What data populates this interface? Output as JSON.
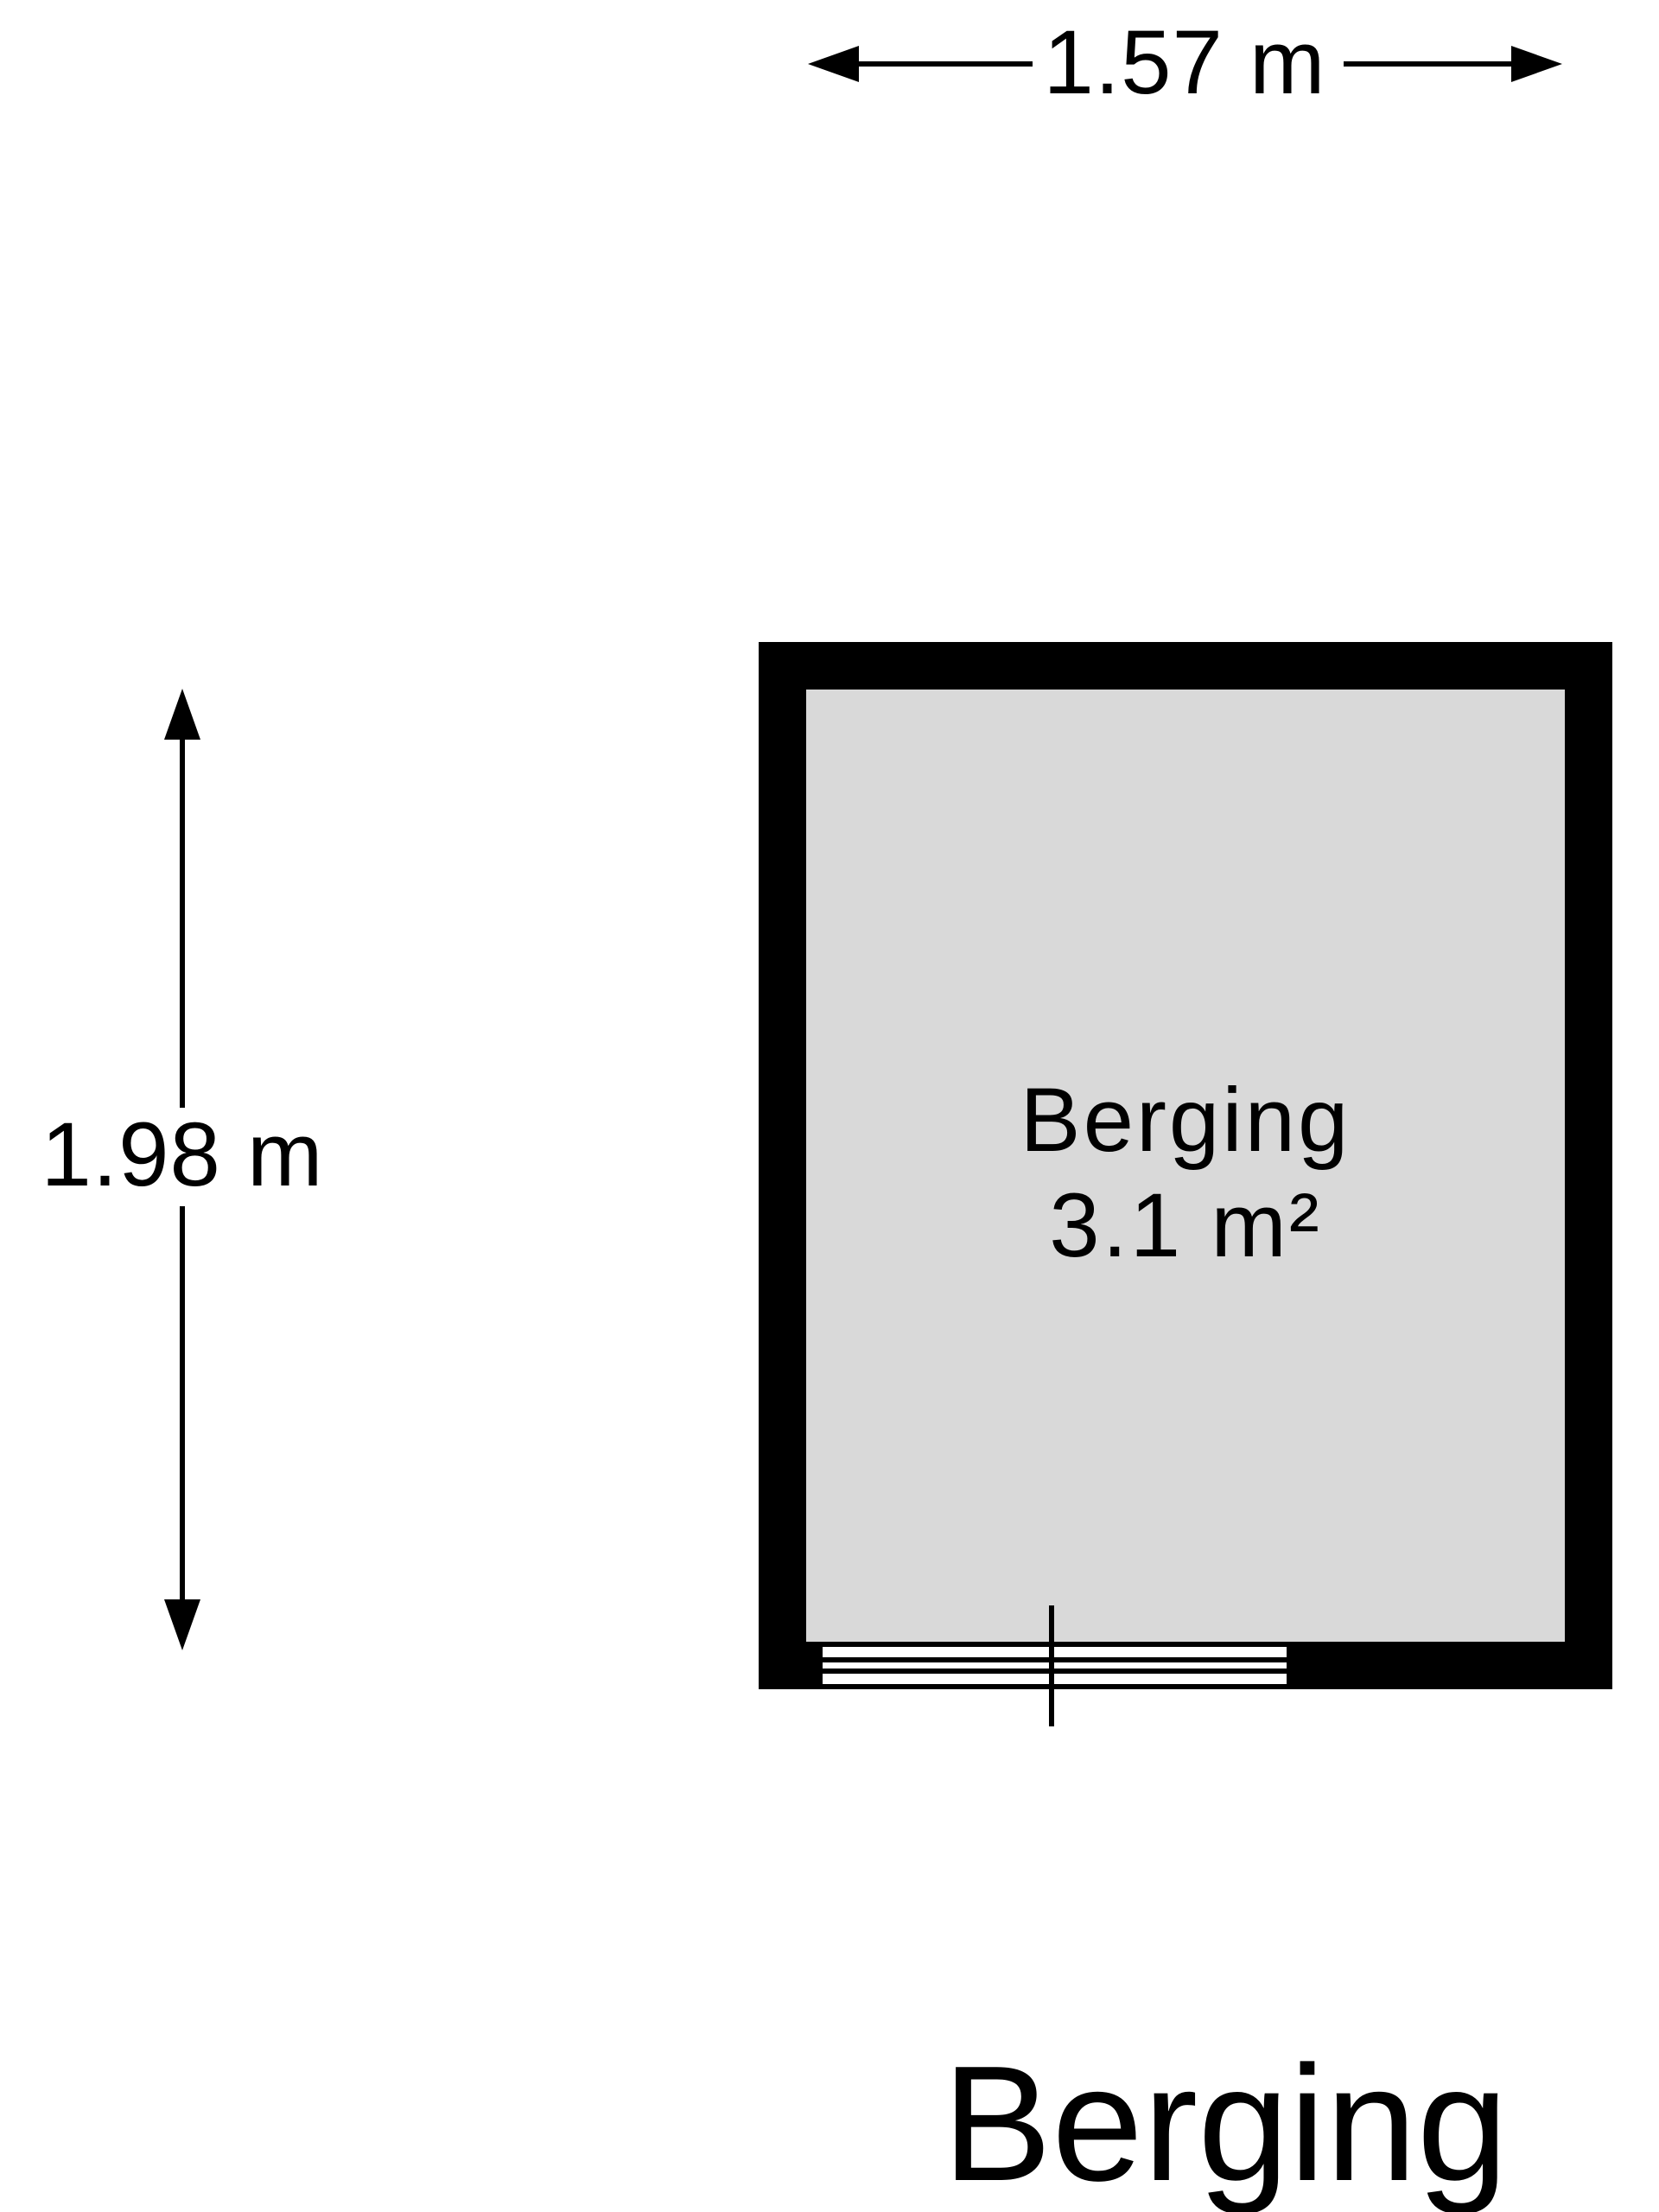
{
  "page": {
    "kind": "floorplan",
    "background": "#ffffff"
  },
  "colors": {
    "wall": "#000000",
    "floor": "#d9d9d9",
    "line": "#000000",
    "text": "#000000"
  },
  "dimensions": {
    "top": {
      "label": "1.57 m"
    },
    "left": {
      "label": "1.98 m"
    }
  },
  "room": {
    "name": "Berging",
    "area": "3.1 m²"
  },
  "title": {
    "text": "Berging"
  }
}
